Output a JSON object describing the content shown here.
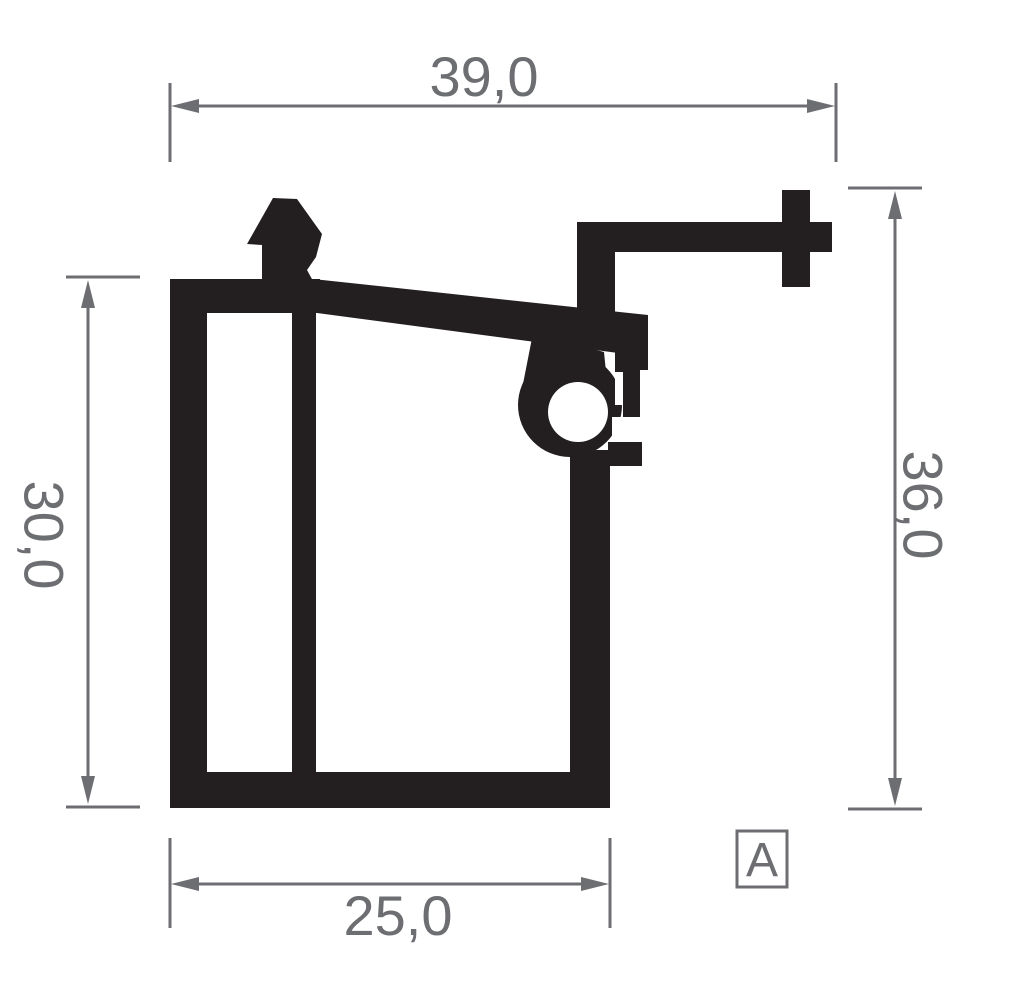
{
  "drawing": {
    "title": "profile-cross-section",
    "dimensions": {
      "top": {
        "label": "39,0"
      },
      "left": {
        "label": "30,0"
      },
      "right": {
        "label": "36,0"
      },
      "bottom": {
        "label": "25,0"
      }
    },
    "section_label": "A"
  },
  "colors": {
    "profile_black": "#231f20",
    "dimension_gray": "#6d6e71",
    "background": "#ffffff"
  }
}
